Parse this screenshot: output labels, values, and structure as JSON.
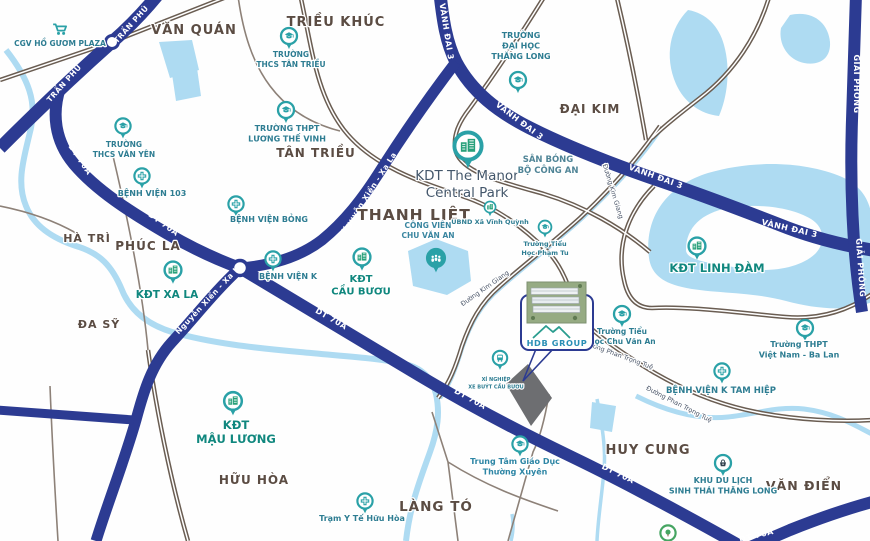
{
  "map": {
    "title": "Ha Noi area project location map",
    "colors": {
      "highway": "#2c3b92",
      "road_casing": "#6a5d52",
      "road_minor": "#8d8178",
      "water": "#aedbf2",
      "site_fill": "#6d6e71",
      "pin_teal": "#2aa1a7",
      "pin_green": "#28a07a",
      "tree_green": "#46a562",
      "basket_dark": "#33424f",
      "area_label": "#5b4c43",
      "place_label": "#2e7d92",
      "kdt_label": "#10877e",
      "manor_label": "#44576b",
      "road_label": "#ffffff",
      "street_label": "#4a5568",
      "logo_teal": "#2a9d8f",
      "logo_text": "#2a8fb5"
    },
    "callout": {
      "logo": "HDB GROUP"
    },
    "area_labels": [
      {
        "text": "VĂN QUÁN",
        "x": 194,
        "y": 34,
        "size": 13
      },
      {
        "text": "TRIỀU KHÚC",
        "x": 336,
        "y": 26,
        "size": 13
      },
      {
        "text": "TÂN TRIỀU",
        "x": 316,
        "y": 157,
        "size": 12
      },
      {
        "text": "ĐẠI KIM",
        "x": 590,
        "y": 113,
        "size": 12
      },
      {
        "text": "THANH LIỆT",
        "x": 414,
        "y": 220,
        "size": 15.5
      },
      {
        "text": "HÀ TRÌ",
        "x": 87,
        "y": 242,
        "size": 11
      },
      {
        "text": "PHÚC LA",
        "x": 148,
        "y": 250,
        "size": 12
      },
      {
        "text": "ĐA SỸ",
        "x": 99,
        "y": 328,
        "size": 11
      },
      {
        "text": "HỮU HÒA",
        "x": 254,
        "y": 484,
        "size": 12
      },
      {
        "text": "LÀNG TÓ",
        "x": 436,
        "y": 511,
        "size": 13.5
      },
      {
        "text": "HUY CUNG",
        "x": 648,
        "y": 454,
        "size": 13
      },
      {
        "text": "VĂN ĐIỂN",
        "x": 804,
        "y": 490,
        "size": 12.5
      }
    ],
    "road_labels": [
      {
        "text": "TRẦN PHÚ",
        "x": 133,
        "y": 26,
        "r": -48,
        "size": 7.5
      },
      {
        "text": "TRẦN PHÚ",
        "x": 66,
        "y": 85,
        "r": -48,
        "size": 7.5
      },
      {
        "text": "VÀNH ĐAI 3",
        "x": 444,
        "y": 32,
        "r": 81,
        "size": 8
      },
      {
        "text": "VÀNH ĐAI 3",
        "x": 518,
        "y": 123,
        "r": 37,
        "size": 8
      },
      {
        "text": "VÀNH ĐAI 3",
        "x": 655,
        "y": 179,
        "r": 20,
        "size": 8
      },
      {
        "text": "VÀNH ĐAI 3",
        "x": 789,
        "y": 231,
        "r": 13,
        "size": 8
      },
      {
        "text": "GIẢI PHÓNG",
        "x": 854,
        "y": 84,
        "r": 90,
        "size": 8
      },
      {
        "text": "GIẢI PHÓNG",
        "x": 858,
        "y": 268,
        "r": 86,
        "size": 8
      },
      {
        "text": "DT 70A",
        "x": 78,
        "y": 161,
        "r": 56,
        "size": 8
      },
      {
        "text": "DT 70A",
        "x": 162,
        "y": 226,
        "r": 36,
        "size": 8
      },
      {
        "text": "DT 70A",
        "x": 330,
        "y": 321,
        "r": 30,
        "size": 8
      },
      {
        "text": "DT 70A",
        "x": 469,
        "y": 401,
        "r": 29,
        "size": 8
      },
      {
        "text": "DT 70A",
        "x": 617,
        "y": 476,
        "r": 26,
        "size": 8
      },
      {
        "text": "DT 70A",
        "x": 757,
        "y": 538,
        "r": -14,
        "size": 8
      },
      {
        "text": "Nguyễn Xiển - Xa La",
        "x": 371,
        "y": 194,
        "r": -57,
        "size": 7.5
      },
      {
        "text": "Nguyễn Xiển - Xa La",
        "x": 211,
        "y": 300,
        "r": -47,
        "size": 7.5
      }
    ],
    "street_labels": [
      {
        "text": "Đường Kim Giang",
        "x": 611,
        "y": 192,
        "r": 73,
        "size": 6.5
      },
      {
        "text": "Đường Kim Giang",
        "x": 486,
        "y": 290,
        "r": -35,
        "size": 6.5
      },
      {
        "text": "Đường Phan Trọng Tuệ",
        "x": 618,
        "y": 357,
        "r": 20,
        "size": 6.5
      },
      {
        "text": "Đường Phan Trọng Tuệ",
        "x": 678,
        "y": 406,
        "r": 27,
        "size": 6.5
      }
    ],
    "places": [
      {
        "id": "cgv-ho-guom-plaza",
        "icon": "cart",
        "x": 60,
        "y": 30,
        "s": 1.25,
        "lines": [
          "CGV HỒ GƯƠM PLAZA"
        ],
        "lx": 60,
        "ly": 46,
        "size": 7.5,
        "bold": true
      },
      {
        "id": "truong-thcs-tan-trieu",
        "icon": "school",
        "x": 289,
        "y": 36,
        "s": 1,
        "lines": [
          "TRƯỜNG",
          "THCS TÂN TRIỀU"
        ],
        "lx": 291,
        "ly": 57,
        "size": 7.5,
        "bold": true
      },
      {
        "id": "truong-thpt-luong-the-vinh",
        "icon": "school",
        "x": 286,
        "y": 110,
        "s": 1,
        "lines": [
          "TRƯỜNG THPT",
          "LƯƠNG THẾ VINH"
        ],
        "lx": 287,
        "ly": 131,
        "size": 8,
        "bold": true
      },
      {
        "id": "truong-dai-hoc-thang-long",
        "icon": "school",
        "x": 518,
        "y": 80,
        "s": 1,
        "lines": [
          "TRƯỜNG",
          "ĐẠI HỌC",
          "THĂNG LONG"
        ],
        "lx": 521,
        "ly": 38,
        "size": 8,
        "bold": true
      },
      {
        "id": "truong-thcs-van-yen",
        "icon": "school",
        "x": 123,
        "y": 126,
        "s": 0.95,
        "lines": [
          "TRƯỜNG",
          "THCS VĂN YÊN"
        ],
        "lx": 124,
        "ly": 147,
        "size": 7.5,
        "bold": true
      },
      {
        "id": "benh-vien-103",
        "icon": "hospital",
        "x": 142,
        "y": 176,
        "s": 0.95,
        "lines": [
          "BỆNH VIỆN 103"
        ],
        "lx": 152,
        "ly": 196,
        "size": 8,
        "bold": true
      },
      {
        "id": "benh-vien-bong",
        "icon": "hospital",
        "x": 236,
        "y": 204,
        "s": 0.95,
        "lines": [
          "BỆNH VIỆN BỎNG"
        ],
        "lx": 269,
        "ly": 222,
        "size": 8,
        "bold": true
      },
      {
        "id": "benh-vien-k",
        "icon": "hospital",
        "x": 273,
        "y": 259,
        "s": 0.95,
        "lines": [
          "BỆNH VIỆN K"
        ],
        "lx": 288,
        "ly": 279,
        "size": 8,
        "bold": true
      },
      {
        "id": "kdt-xa-la",
        "icon": "building",
        "x": 173,
        "y": 270,
        "s": 1.05,
        "lines": [
          "KĐT XA LA"
        ],
        "lx": 167,
        "ly": 298,
        "size": 10.5,
        "bold": true,
        "color": "#10877e"
      },
      {
        "id": "kdt-the-manor-central-park",
        "icon": "building",
        "x": 468,
        "y": 146,
        "s": 1.7,
        "lines": [
          "KDT The Manor",
          "Central Park"
        ],
        "lx": 467,
        "ly": 180,
        "size": 13.5,
        "bold": false,
        "color": "#44576b",
        "lh": 17
      },
      {
        "id": "san-bong-bo-cong-an",
        "icon": "none",
        "x": 548,
        "y": 150,
        "s": 1,
        "lines": [
          "SÂN BÓNG",
          "BỘ CÔNG AN"
        ],
        "lx": 548,
        "ly": 162,
        "size": 8.5,
        "bold": true,
        "color": "#4f8496"
      },
      {
        "id": "cong-vien-chu-van-an",
        "icon": "park",
        "x": 436,
        "y": 258,
        "s": 1.1,
        "lines": [
          "CÔNG VIÊN",
          "CHU VĂN AN"
        ],
        "lx": 428,
        "ly": 228,
        "size": 7.5,
        "bold": true,
        "color": "#3a86a0"
      },
      {
        "id": "ubnd-xa-vinh-quynh",
        "icon": "building",
        "x": 490,
        "y": 207,
        "s": 0.7,
        "lines": [
          "UBND Xã Vĩnh Quỳnh"
        ],
        "lx": 490,
        "ly": 224,
        "size": 6.5,
        "bold": true
      },
      {
        "id": "truong-tieu-hoc-pham-tu",
        "icon": "school",
        "x": 545,
        "y": 227,
        "s": 0.8,
        "lines": [
          "Trường Tiểu",
          "Học Phạm Tu"
        ],
        "lx": 545,
        "ly": 246,
        "size": 6.5,
        "bold": true
      },
      {
        "id": "kdt-linh-dam",
        "icon": "building",
        "x": 697,
        "y": 246,
        "s": 1.05,
        "lines": [
          "KĐT LINH ĐÀM"
        ],
        "lx": 717,
        "ly": 272,
        "size": 11.5,
        "bold": true,
        "color": "#10877e"
      },
      {
        "id": "kdt-cau-buou",
        "icon": "building",
        "x": 362,
        "y": 257,
        "s": 1.05,
        "lines": [
          "KĐT",
          "CẦU BƯƠU"
        ],
        "lx": 361,
        "ly": 282,
        "size": 10,
        "bold": true,
        "color": "#10877e"
      },
      {
        "id": "benh-vien-k-tam-hiep",
        "icon": "hospital",
        "x": 722,
        "y": 371,
        "s": 0.95,
        "lines": [
          "BỆNH VIỆN K TAM HIỆP"
        ],
        "lx": 721,
        "ly": 393,
        "size": 8.5,
        "bold": true
      },
      {
        "id": "truong-tieu-hoc-chu-van-an",
        "icon": "school",
        "x": 622,
        "y": 314,
        "s": 1,
        "lines": [
          "Trường Tiểu",
          "Học Chu Văn An"
        ],
        "lx": 622,
        "ly": 334,
        "size": 7.5,
        "bold": true
      },
      {
        "id": "truong-thpt-viet-nam-ba-lan",
        "icon": "school",
        "x": 805,
        "y": 328,
        "s": 1,
        "lines": [
          "Trường THPT",
          "Việt Nam - Ba Lan"
        ],
        "lx": 799,
        "ly": 347,
        "size": 8,
        "bold": true
      },
      {
        "id": "xi-nghiep-xe-buyt-cau-buou",
        "icon": "bus",
        "x": 500,
        "y": 358,
        "s": 0.9,
        "lines": [
          "XÍ NGHIỆP",
          "XE BUÝT CẦU BƯƠU"
        ],
        "lx": 496,
        "ly": 381,
        "size": 5,
        "bold": true
      },
      {
        "id": "kdt-mau-luong",
        "icon": "building",
        "x": 233,
        "y": 401,
        "s": 1.1,
        "lines": [
          "KĐT",
          "MẬU LƯƠNG"
        ],
        "lx": 236,
        "ly": 429,
        "size": 11.5,
        "bold": true,
        "color": "#10877e"
      },
      {
        "id": "trung-tam-giao-duc-thuong-xuyen",
        "icon": "school",
        "x": 520,
        "y": 444,
        "s": 0.95,
        "lines": [
          "Trung Tâm Giáo Dục",
          "Thường Xuyên"
        ],
        "lx": 515,
        "ly": 464,
        "size": 8,
        "bold": true,
        "color": "#2e86a5"
      },
      {
        "id": "tram-y-te-huu-hoa",
        "icon": "hospital",
        "x": 365,
        "y": 501,
        "s": 0.95,
        "lines": [
          "Trạm Y Tế Hữu Hòa"
        ],
        "lx": 362,
        "ly": 521,
        "size": 8,
        "bold": true
      },
      {
        "id": "khu-du-lich-sinh-thai-thang-long",
        "icon": "tourism",
        "x": 723,
        "y": 463,
        "s": 1,
        "lines": [
          "KHU DU LỊCH",
          "SINH THÁI THĂNG LONG"
        ],
        "lx": 723,
        "ly": 483,
        "size": 8,
        "bold": true
      },
      {
        "id": "park-tree",
        "icon": "tree",
        "x": 668,
        "y": 533,
        "s": 0.95,
        "lines": [],
        "lx": 668,
        "ly": 550,
        "size": 7,
        "bold": false
      }
    ]
  }
}
